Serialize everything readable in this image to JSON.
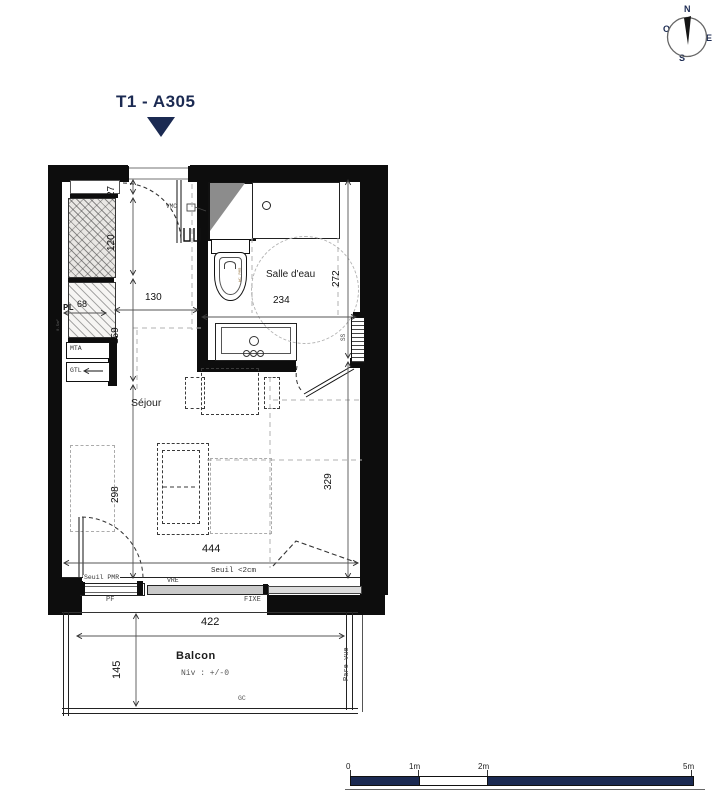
{
  "title": {
    "text": "T1 - A305"
  },
  "compass": {
    "north": "N",
    "east": "E",
    "south": "S",
    "west": "O"
  },
  "rooms": {
    "bathroom": {
      "name": "Salle d'eau",
      "width_cm": "234",
      "height_cm": "272"
    },
    "living": {
      "name": "Séjour",
      "width_cm": "444",
      "height_cm": "329"
    },
    "balcony": {
      "name": "Balcon",
      "level": "Niv : +/-0",
      "width_cm": "422",
      "depth_cm": "145"
    }
  },
  "dims": {
    "niche": "27",
    "entry": "120",
    "closet": "68",
    "kitchen": "130",
    "mid": "159",
    "bed": "298"
  },
  "equipment": {
    "vmc": "VMC",
    "mta": "MTA",
    "gtl": "GTL",
    "closet": "PL",
    "closet_area": "0.5m²",
    "towel_rail": "SS",
    "wc": "WC PMR"
  },
  "openings": {
    "pf": "PF",
    "vre": "VRE",
    "fixe": "FIXE",
    "seuil_pmr": "Seuil PMR",
    "seuil": "Seuil <2cm"
  },
  "balcony_extra": {
    "gc": "GC",
    "pare_vue": "Pare vue"
  },
  "scalebar": {
    "m0": "0",
    "m1": "1m",
    "m2": "2m",
    "m5": "5m"
  },
  "colors": {
    "navy": "#1b2a52",
    "wall": "#0d0d0d",
    "dash_gray": "#a8a8a8",
    "line": "#444444"
  }
}
